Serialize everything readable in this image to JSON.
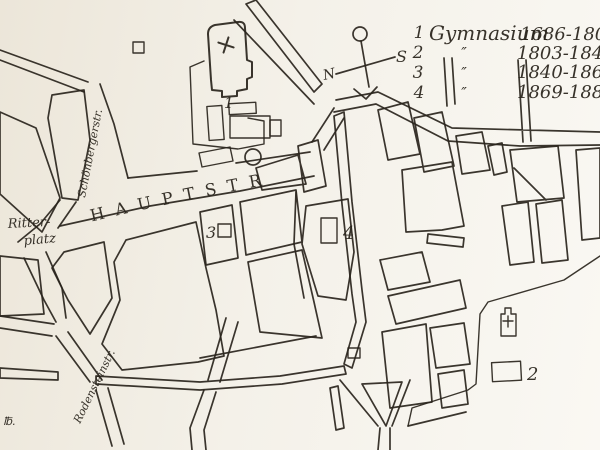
{
  "palette": {
    "ink": "#29241c",
    "paper": "#f2eee4",
    "paper_light": "#faf8f3"
  },
  "legend": {
    "rows": [
      {
        "num": "1",
        "name": "Gymnasium",
        "years": "1686-1803"
      },
      {
        "num": "2",
        "name": "″",
        "years": "1803-1840"
      },
      {
        "num": "3",
        "name": "″",
        "years": "1840-1869"
      },
      {
        "num": "4",
        "name": "″",
        "years": "1869-1882"
      }
    ]
  },
  "compass": {
    "north": "N",
    "south": "S"
  },
  "streets": {
    "hauptstrasse": "HAUPTSTR",
    "schoenbergerstrasse": "Schönbergerstr.",
    "rodensteinstrasse": "Rodensteinstr."
  },
  "places": {
    "ritterplatz_line1": "Ritter-",
    "ritterplatz_line2": "platz"
  },
  "map_markers": {
    "gymnasium_1": "1",
    "gymnasium_2": "2",
    "gymnasium_3": "3",
    "gymnasium_4": "4"
  },
  "signature": "℔."
}
